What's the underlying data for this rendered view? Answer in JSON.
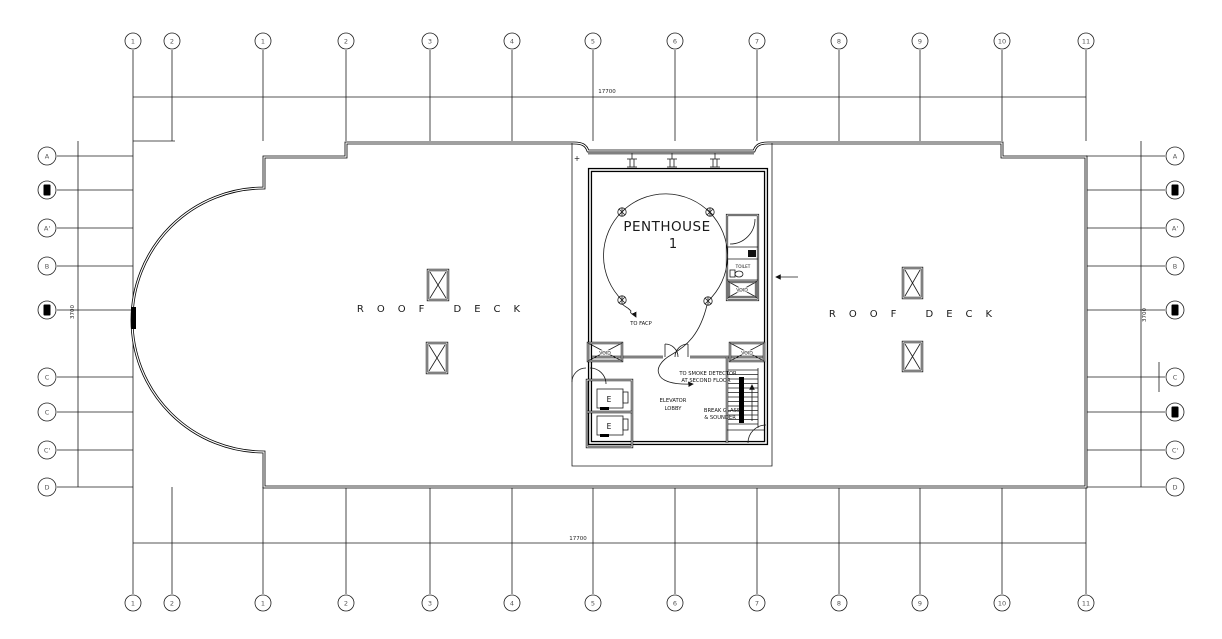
{
  "grid": {
    "columns": [
      "1",
      "2",
      "1",
      "2",
      "3",
      "4",
      "5",
      "6",
      "7",
      "8",
      "9",
      "10",
      "11"
    ],
    "rows_left": [
      "A",
      "▮",
      "A'",
      "B",
      "▮",
      "C",
      "C",
      "C'",
      "D"
    ],
    "rows_right": [
      "A",
      "▮",
      "A'",
      "B",
      "▮",
      "C",
      "▮",
      "C'",
      "D"
    ]
  },
  "labels": {
    "penthouse": "PENTHOUSE",
    "penthouse_number": "1",
    "roof_deck_left": "ROOF DECK",
    "roof_deck_right": "ROOF DECK",
    "elevator_line1": "ELEVATOR",
    "elevator_line2": "LOBBY",
    "to_facp": "TO FACP",
    "to_smoke_line1": "TO SMOKE DETECTOR",
    "to_smoke_line2": "AT SECOND FLOOR",
    "break_glass_line1": "BREAK GLASS",
    "break_glass_line2": "& SOUNDER",
    "toilet": "TOILET",
    "void": "VOID",
    "elevator_car": "E",
    "plus_marker": "+"
  },
  "dimensions": {
    "top_overall": "17700",
    "bottom_overall": "17700",
    "left_overall": "3700",
    "right_overall": "3700"
  }
}
